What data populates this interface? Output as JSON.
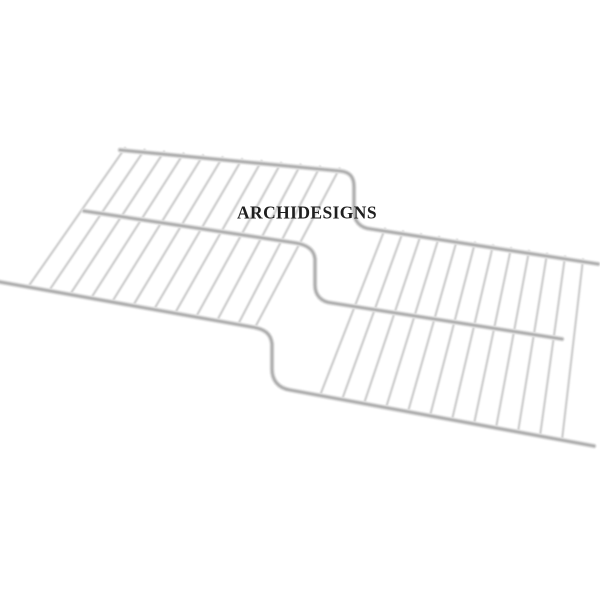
{
  "meta": {
    "type": "product-photograph",
    "description": "White epoxy-coated wire shelf with a Z-shaped step-down offset in the middle, shown in perspective on a plain white background"
  },
  "watermark": {
    "text": "ARCHIDESIGNS",
    "color": "#1f1f1f"
  },
  "canvas": {
    "background_color": "#ffffff",
    "rail_color": "#b0b0b0",
    "grid_wire_color": "#cdcdcd"
  }
}
